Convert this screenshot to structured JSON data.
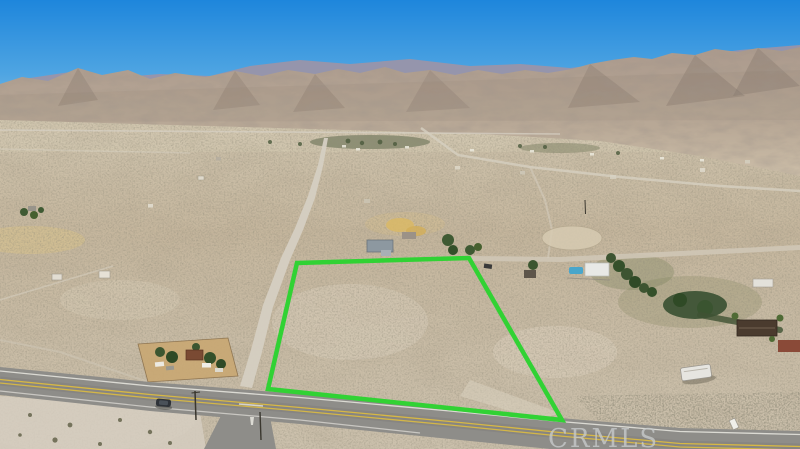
{
  "scene": {
    "description": "Aerial drone photo of a vacant desert land parcel outlined in green beside a highway intersection, desert valley with scattered homes, and mountain range under a blue sky",
    "parcel": "vacant desert lot outlined in green",
    "foreground": "paved highway with double yellow center line and dark car",
    "background": "rocky desert mountain range and blue gradient sky"
  },
  "watermark": {
    "text": "CRMLS",
    "color": "#c7caca"
  },
  "colors": {
    "sky_top": "#1e86dc",
    "sky_mid": "#4fa5e2",
    "sky_horizon": "#92c4e9",
    "mountain_top": "#b0a093",
    "mountain_base": "#cabba6",
    "far_ridge": "#9d94a6",
    "desert_top": "#cec2ab",
    "desert_mid": "#c6b79e",
    "desert_bottom": "#ccc1ad",
    "dirt_road": "#d5cfc2",
    "highway_asphalt": "#8e8d89",
    "lane_yellow": "#d7b844",
    "edge_white": "#e9e7e0",
    "parcel_outline": "#31d234",
    "pool": "#49a6cb",
    "vegetation": "#3f5a33",
    "dirt_lot": "#c9a873"
  }
}
